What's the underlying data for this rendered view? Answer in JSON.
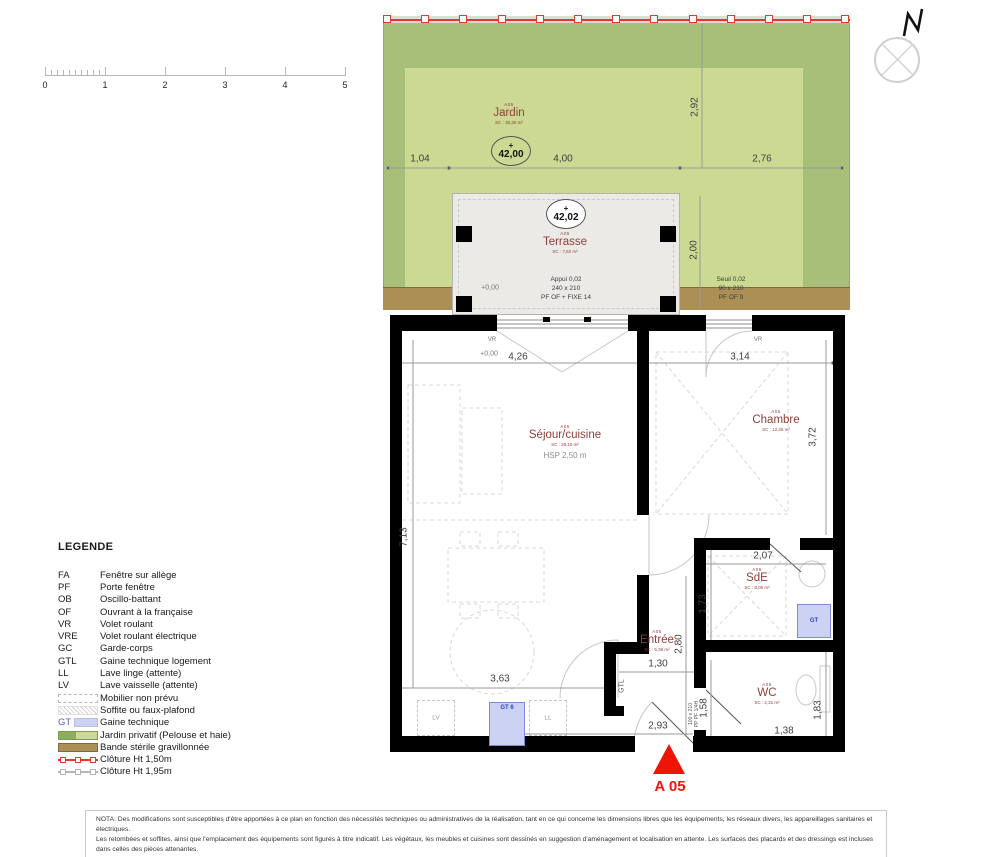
{
  "colors": {
    "garden-dark": "#a7bf78",
    "garden-light": "#cbd993",
    "gravel": "#ab8f55",
    "gravel-border": "#7f693f",
    "terrace-bg": "#ebeae7",
    "wall": "#000000",
    "room-text": "#8e3f38",
    "dim-text": "#3f3f3f",
    "fence-red": "#e03a2d",
    "fence-gray": "#b5b5b5",
    "marker-red": "#ee1508",
    "gt-bg": "#ccd2f4",
    "gt-border": "#8089d4",
    "gt-text": "#2f3fbe",
    "legend-text": "#1a1a1a"
  },
  "scale_bar": {
    "labels": [
      "0",
      "1",
      "2",
      "3",
      "4",
      "5"
    ]
  },
  "compass": {
    "north": "N"
  },
  "garden": {
    "code": "A05",
    "name": "Jardin",
    "area": "SC : 30,30 m²",
    "level_plus": "+",
    "level": "42,00",
    "dim_left": "1,04",
    "dim_mid": "4,00",
    "dim_right": "2,76",
    "dim_vert": "2,92"
  },
  "terrace": {
    "code": "A05",
    "name": "Terrasse",
    "area": "SC : 7,82 m²",
    "level_plus": "+",
    "level": "42,02",
    "dim_vert": "2,00",
    "level_zero": "+0,00",
    "appui": [
      "Appui 0,02",
      "240 x 210",
      "PF OF + FIXE 14"
    ],
    "seuil": [
      "Seuil 0,02",
      "90 x 210",
      "PF OF 9"
    ]
  },
  "plan": {
    "level_zero": "+0,00",
    "vr": "VR",
    "rooms": {
      "sejour": {
        "code": "A05",
        "name": "Séjour/cuisine",
        "area": "SC : 28,16 m²",
        "hsp": "HSP 2,50 m"
      },
      "chambre": {
        "code": "A05",
        "name": "Chambre",
        "area": "SC : 12,26 m²"
      },
      "sde": {
        "code": "A05",
        "name": "SdE",
        "area": "SC : 3,05 m²"
      },
      "entree": {
        "code": "A05",
        "name": "Entrée",
        "area": "SC : 5,36 m²"
      },
      "wc": {
        "code": "A05",
        "name": "WC",
        "area": "SC : 2,31 m²"
      }
    },
    "dims": {
      "sejour_top": "4,26",
      "chambre_top": "3,14",
      "chambre_right": "3,72",
      "sejour_left": "7,13",
      "sde_top": "2,07",
      "sde_left": "1,73",
      "entree_w": "1,30",
      "entree_h": "2,80",
      "sejour_bottom": "3,63",
      "entry_w": "2,93",
      "wc_left": "1,58",
      "wc_right": "1,83",
      "wc_bottom": "1,38"
    },
    "labels": {
      "gtl": "GTL",
      "gt": "GT",
      "gt6": "GT 6",
      "lv": "LV",
      "ll": "LL",
      "entry_door_size": "100 x 210",
      "entry_door_type": "PP PF 1/4H"
    }
  },
  "marker": {
    "label": "A 05"
  },
  "legend": {
    "title": "LEGENDE",
    "abbreviations": [
      {
        "abbr": "FA",
        "label": "Fenêtre sur allège"
      },
      {
        "abbr": "PF",
        "label": "Porte fenêtre"
      },
      {
        "abbr": "OB",
        "label": "Oscillo-battant"
      },
      {
        "abbr": "OF",
        "label": "Ouvrant à la française"
      },
      {
        "abbr": "VR",
        "label": "Volet roulant"
      },
      {
        "abbr": "VRE",
        "label": "Volet roulant électrique"
      },
      {
        "abbr": "GC",
        "label": "Garde-corps"
      },
      {
        "abbr": "GTL",
        "label": "Gaine technique logement"
      },
      {
        "abbr": "LL",
        "label": "Lave linge (attente)"
      },
      {
        "abbr": "LV",
        "label": "Lave vaisselle (attente)"
      }
    ],
    "swatches": [
      {
        "type": "dashed-box",
        "label": "Mobilier non prévu"
      },
      {
        "type": "hatch",
        "label": "Soffite ou faux-plafond"
      },
      {
        "type": "gt",
        "abbr": "GT",
        "label": "Gaine technique"
      },
      {
        "type": "garden",
        "label": "Jardin privatif (Pelouse et haie)"
      },
      {
        "type": "gravel",
        "label": "Bande stérile gravillonnée"
      },
      {
        "type": "fence-red",
        "label": "Clôture  Ht 1,50m"
      },
      {
        "type": "fence-gray",
        "label": "Clôture  Ht 1,95m"
      }
    ]
  },
  "nota": {
    "line1": "NOTA: Des modifications sont susceptibles d'être apportées à ce plan en fonction des nécessités techniques ou administratives de la réalisation, tant en ce qui concerne les dimensions libres que les équipements, les réseaux divers, les appareillages sanitaires et électriques.",
    "line2": "Les retombées et soffites, ainsi que l'emplacement des équipements sont figurés à titre indicatif. Les végétaux, les meubles et cuisines sont dessinés en suggestion d'aménagement et localisation en attente. Les surfaces des placards et des dressings est incluses dans celles des pièces attenantes."
  }
}
